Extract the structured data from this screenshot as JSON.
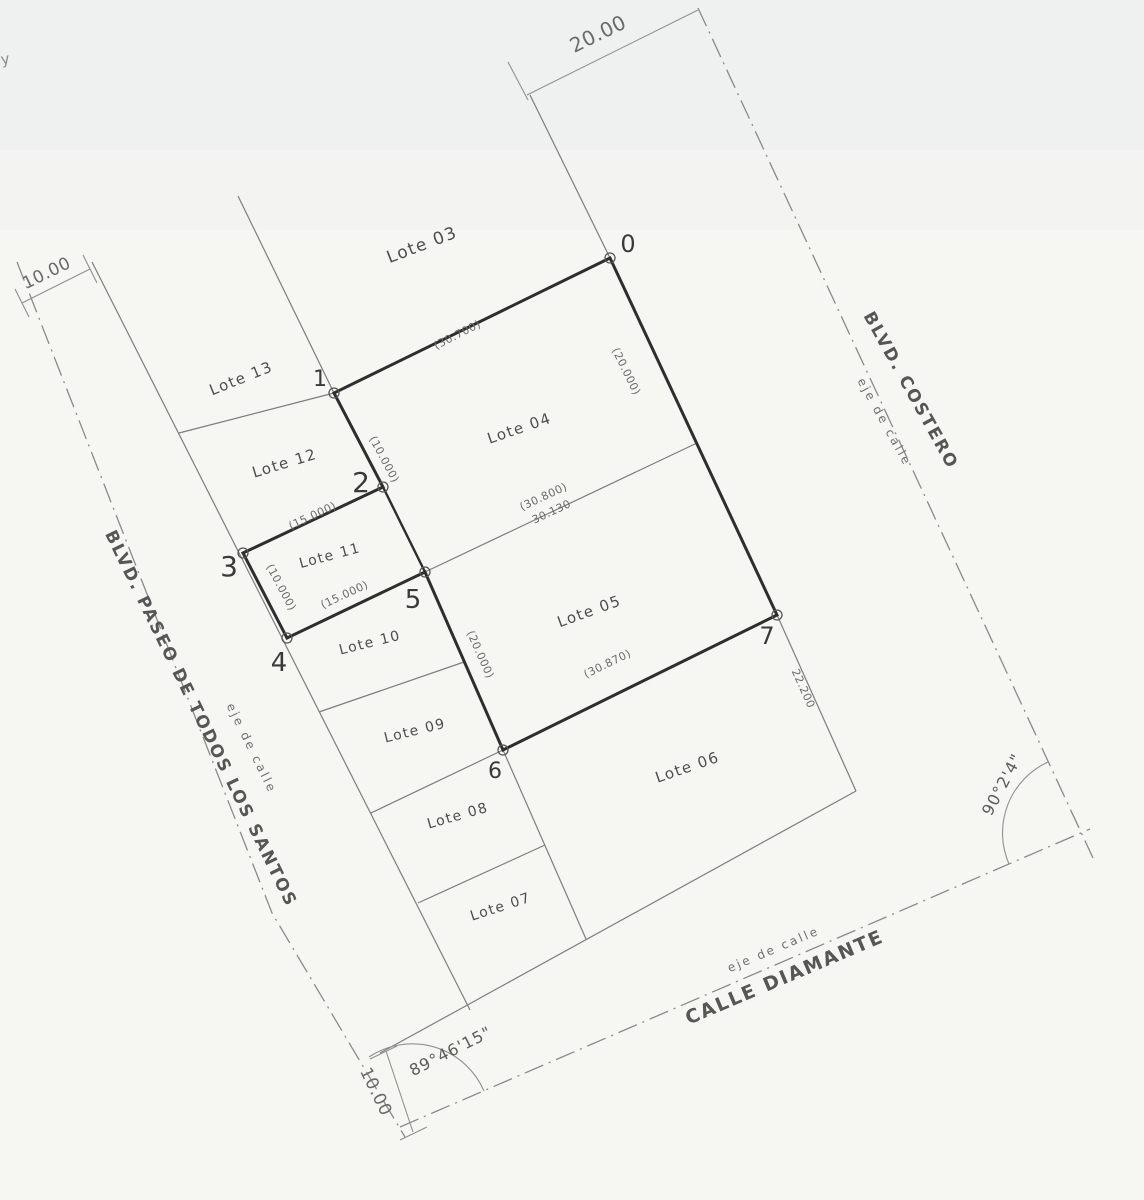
{
  "colors": {
    "paper": "#f6f6f2",
    "top_tint": "#dbe7ee",
    "ink_thick": "#2e2e2e",
    "ink_thin": "#7d7d7d",
    "ink_light": "#909090",
    "centerline": "#8a8a8a"
  },
  "lots": [
    {
      "label": "Lote 03",
      "x": 424,
      "y": 250,
      "rot": -21,
      "size": 17
    },
    {
      "label": "Lote 04",
      "x": 521,
      "y": 433,
      "rot": -19,
      "size": 15
    },
    {
      "label": "Lote 05",
      "x": 591,
      "y": 616,
      "rot": -20,
      "size": 15
    },
    {
      "label": "Lote 06",
      "x": 689,
      "y": 772,
      "rot": -19,
      "size": 15
    },
    {
      "label": "Lote 07",
      "x": 502,
      "y": 911,
      "rot": -18,
      "size": 14
    },
    {
      "label": "Lote 08",
      "x": 459,
      "y": 820,
      "rot": -16,
      "size": 14
    },
    {
      "label": "Lote 09",
      "x": 416,
      "y": 735,
      "rot": -14,
      "size": 14
    },
    {
      "label": "Lote 10",
      "x": 371,
      "y": 647,
      "rot": -14,
      "size": 14
    },
    {
      "label": "Lote 11",
      "x": 331,
      "y": 560,
      "rot": -15,
      "size": 14
    },
    {
      "label": "Lote 12",
      "x": 286,
      "y": 468,
      "rot": -17,
      "size": 15
    },
    {
      "label": "Lote 13",
      "x": 243,
      "y": 383,
      "rot": -22,
      "size": 15
    }
  ],
  "vertices": [
    {
      "label": "0",
      "cx": 610,
      "cy": 258,
      "tx": 628,
      "ty": 252,
      "size": 24
    },
    {
      "label": "1",
      "cx": 334,
      "cy": 393,
      "tx": 320,
      "ty": 386,
      "size": 22
    },
    {
      "label": "2",
      "cx": 383,
      "cy": 487,
      "tx": 361,
      "ty": 492,
      "size": 28
    },
    {
      "label": "3",
      "cx": 243,
      "cy": 553,
      "tx": 229,
      "ty": 576,
      "size": 28
    },
    {
      "label": "4",
      "cx": 287,
      "cy": 638,
      "tx": 279,
      "ty": 671,
      "size": 26
    },
    {
      "label": "5",
      "cx": 425,
      "cy": 572,
      "tx": 413,
      "ty": 608,
      "size": 26
    },
    {
      "label": "6",
      "cx": 503,
      "cy": 750,
      "tx": 495,
      "ty": 778,
      "size": 22
    },
    {
      "label": "7",
      "cx": 777,
      "cy": 615,
      "tx": 767,
      "ty": 644,
      "size": 24
    }
  ],
  "dimensions": [
    {
      "text": "20.00",
      "x": 601,
      "y": 40,
      "rot": -26,
      "size": 20
    },
    {
      "text": "10.00",
      "x": 49,
      "y": 278,
      "rot": -26,
      "size": 17
    },
    {
      "text": "10.00",
      "x": 371,
      "y": 1094,
      "rot": 64,
      "size": 17
    },
    {
      "text": "(30.700)",
      "x": 459,
      "y": 338,
      "rot": -27,
      "size": 11
    },
    {
      "text": "(20.000)",
      "x": 623,
      "y": 373,
      "rot": 64,
      "size": 11
    },
    {
      "text": "(10.000)",
      "x": 381,
      "y": 461,
      "rot": 62,
      "size": 11
    },
    {
      "text": "(15.000)",
      "x": 314,
      "y": 519,
      "rot": -25,
      "size": 11
    },
    {
      "text": "(10.000)",
      "x": 278,
      "y": 589,
      "rot": 62,
      "size": 11
    },
    {
      "text": "(15.000)",
      "x": 346,
      "y": 598,
      "rot": -25,
      "size": 11
    },
    {
      "text": "(30.800)",
      "x": 545,
      "y": 500,
      "rot": -25,
      "size": 11
    },
    {
      "text": "30.130",
      "x": 553,
      "y": 515,
      "rot": -25,
      "size": 11
    },
    {
      "text": "(20.000)",
      "x": 477,
      "y": 656,
      "rot": 66,
      "size": 11
    },
    {
      "text": "(30.870)",
      "x": 609,
      "y": 667,
      "rot": -26,
      "size": 11
    },
    {
      "text": "22.200",
      "x": 800,
      "y": 690,
      "rot": 66,
      "size": 11
    }
  ],
  "angles": [
    {
      "text": "89°46'15\"",
      "x": 453,
      "y": 1056,
      "rot": -27,
      "size": 16,
      "arc": "M 369 1057 A 78 78 0 0 1 484 1091"
    },
    {
      "text": "90°2'4\"",
      "x": 1007,
      "y": 787,
      "rot": -62,
      "size": 16,
      "arc": "M 1048 762 A 78 78 0 0 0 1009 864"
    }
  ],
  "streets": [
    {
      "name": "BLVD. COSTERO",
      "axis_label": "eje de calle",
      "name_x": 906,
      "name_y": 393,
      "name_rot": 61,
      "name_size": 17,
      "axis_x": 881,
      "axis_y": 424,
      "axis_rot": 61,
      "axis_size": 12,
      "centerline": [
        698,
        8,
        1093,
        858
      ]
    },
    {
      "name": "BLVD. PASEO DE TODOS LOS SANTOS",
      "axis_label": "eje de calle",
      "name_x": 196,
      "name_y": 721,
      "name_rot": 64,
      "name_size": 17,
      "axis_x": 248,
      "axis_y": 750,
      "axis_rot": 64,
      "axis_size": 12,
      "centerline": [
        17,
        262,
        118,
        520,
        272,
        913,
        405,
        1137
      ]
    },
    {
      "name": "CALLE DIAMANTE",
      "axis_label": "eje de calle",
      "name_x": 787,
      "name_y": 983,
      "name_rot": -23,
      "name_size": 19,
      "axis_x": 775,
      "axis_y": 953,
      "axis_rot": -23,
      "axis_size": 12,
      "centerline": [
        400,
        1127,
        1090,
        829
      ]
    }
  ],
  "geometry": {
    "parcel_outline": [
      610,
      258,
      334,
      393,
      383,
      487,
      243,
      553,
      287,
      638,
      425,
      572,
      503,
      750,
      777,
      615
    ],
    "lot_lines": [
      [
        238,
        196,
        334,
        393
      ],
      [
        334,
        393,
        179,
        433
      ],
      [
        92,
        262,
        470,
        1010
      ],
      [
        530,
        95,
        610,
        258
      ],
      [
        777,
        615,
        856,
        791
      ],
      [
        462,
        1008,
        856,
        791
      ],
      [
        503,
        750,
        586,
        939
      ],
      [
        319,
        712,
        464,
        662
      ],
      [
        371,
        813,
        503,
        750
      ],
      [
        418,
        903,
        545,
        845
      ],
      [
        462,
        1008,
        380,
        1053
      ]
    ],
    "interior_lines": [
      {
        "pts": [
          383,
          487,
          425,
          572
        ],
        "w": 2.4
      },
      {
        "pts": [
          425,
          572,
          697,
          443
        ],
        "w": 1.2
      }
    ],
    "dim_lines": [
      [
        527,
        95,
        698,
        10
      ],
      [
        508,
        62,
        528,
        100
      ],
      [
        22,
        303,
        90,
        269
      ],
      [
        15,
        289,
        29,
        317
      ],
      [
        83,
        255,
        97,
        283
      ],
      [
        386,
        1051,
        413,
        1132
      ],
      [
        370,
        1059,
        397,
        1046
      ],
      [
        400,
        1140,
        427,
        1127
      ]
    ]
  },
  "artifacts": [
    {
      "text": "y",
      "x": 6,
      "y": 64,
      "rot": -10,
      "size": 15
    }
  ]
}
